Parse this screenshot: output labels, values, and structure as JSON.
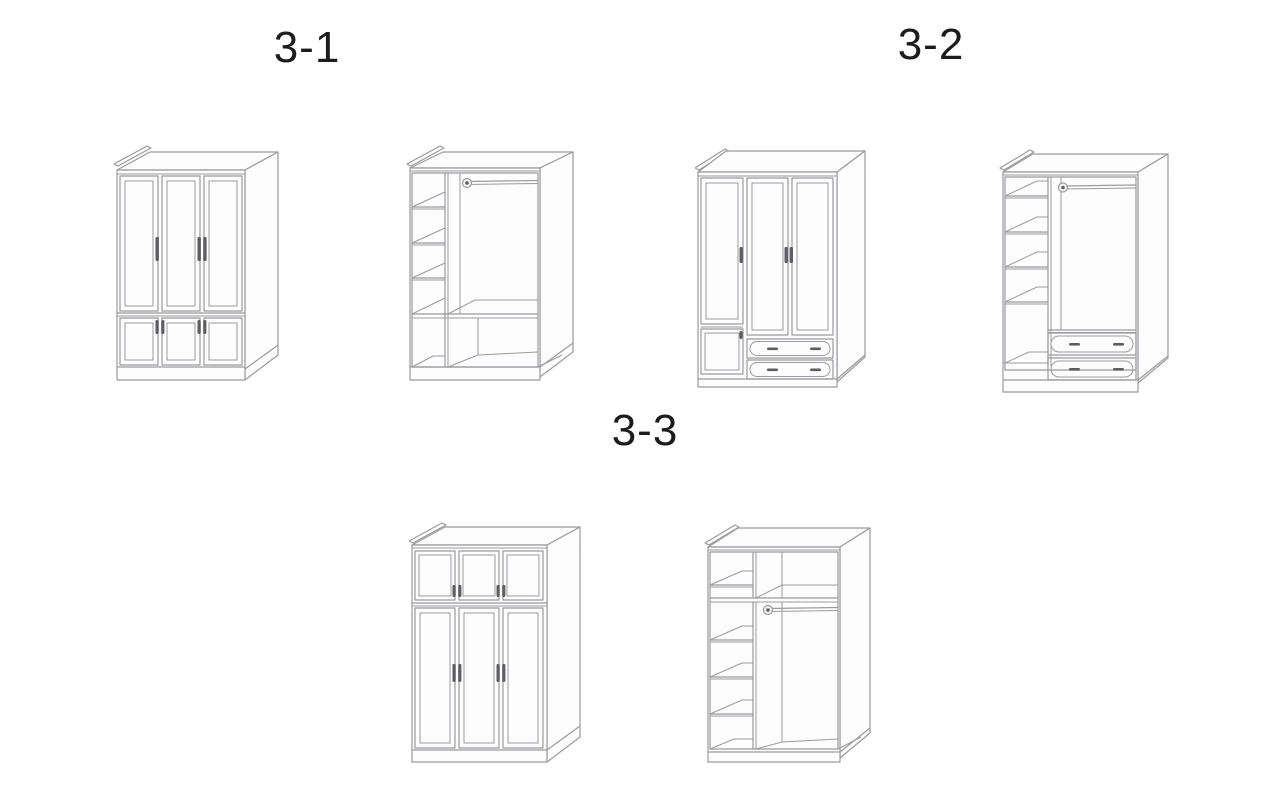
{
  "page": {
    "background": "#ffffff",
    "description_labels_visible": [
      "3-1",
      "3-2",
      "3-3"
    ]
  },
  "drawing_style": {
    "line_color": "#9a9aa0",
    "handle_color": "#5d5d63",
    "label_color": "#1c1c1c"
  },
  "figures": [
    {
      "id": "3-1",
      "label": "3-1",
      "views": [
        {
          "name": "wardrobe-closed-front-view",
          "features": "three framed doors, three small lower doors, vertical bar handles, top back rail, plinth base"
        },
        {
          "name": "wardrobe-open-interior-view",
          "features": "left shelf column with three shelves, full-width shelf, hanging rod with round flange, open lower compartments"
        }
      ]
    },
    {
      "id": "3-2",
      "label": "3-2",
      "views": [
        {
          "name": "wardrobe-closed-front-view",
          "features": "three framed doors, small lower-left door, two lower drawers with oval fronts and twin handles, top back rail, plinth base"
        },
        {
          "name": "wardrobe-open-interior-view",
          "features": "left shelf column with four shelves, hanging rod with round flange, two lower drawers with oval fronts"
        }
      ]
    },
    {
      "id": "3-3",
      "label": "3-3",
      "views": [
        {
          "name": "wardrobe-closed-front-view",
          "features": "three small upper doors, three tall lower doors, paired bar handles, top back rail, plinth base"
        },
        {
          "name": "wardrobe-open-interior-view",
          "features": "full-width top shelf, divided upper cells, hanging rod with round flange, left shelf column with three shelves"
        }
      ]
    }
  ]
}
